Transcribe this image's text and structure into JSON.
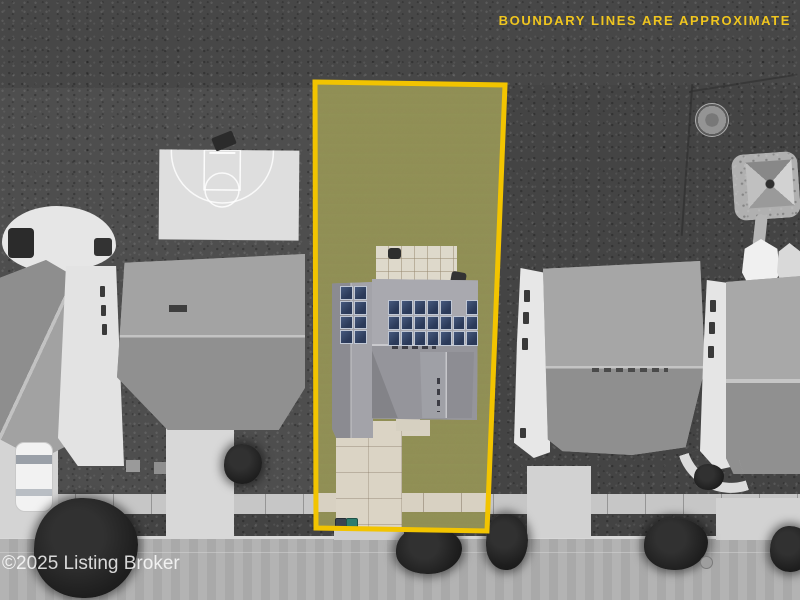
{
  "overlay": {
    "disclaimer": "BOUNDARY LINES ARE APPROXIMATE",
    "disclaimer_color": "#EFC51F",
    "watermark": "©2025 Listing Broker",
    "watermark_color": "#FFFFFF",
    "boundary_color": "#F2C400"
  },
  "scene": {
    "subject_lot": {
      "label": "highlighted-lot-in-color",
      "grass_color": "#7AA24F",
      "roof_color": "#9C9CA2",
      "driveway_color": "#DBD4C5",
      "solar_panel_color": "#31435F",
      "solar_arrays": {
        "left_array": {
          "rows": 4,
          "cols": 2
        },
        "main_array": {
          "rows": 3,
          "cols": 7,
          "missing_cells": [
            [
              0,
              5
            ]
          ]
        }
      },
      "trash_bins": [
        {
          "color": "#3A4450"
        },
        {
          "color": "#2E7D6E"
        }
      ]
    },
    "surroundings": {
      "style": "grayscale",
      "features": [
        "scrub-field",
        "basketball-court",
        "concrete-patio",
        "hot-tub",
        "neighbor-houses",
        "white-car",
        "trampoline",
        "playground",
        "gazebos",
        "sidewalk",
        "street",
        "street-trees",
        "trash-bins",
        "driveways"
      ]
    }
  }
}
